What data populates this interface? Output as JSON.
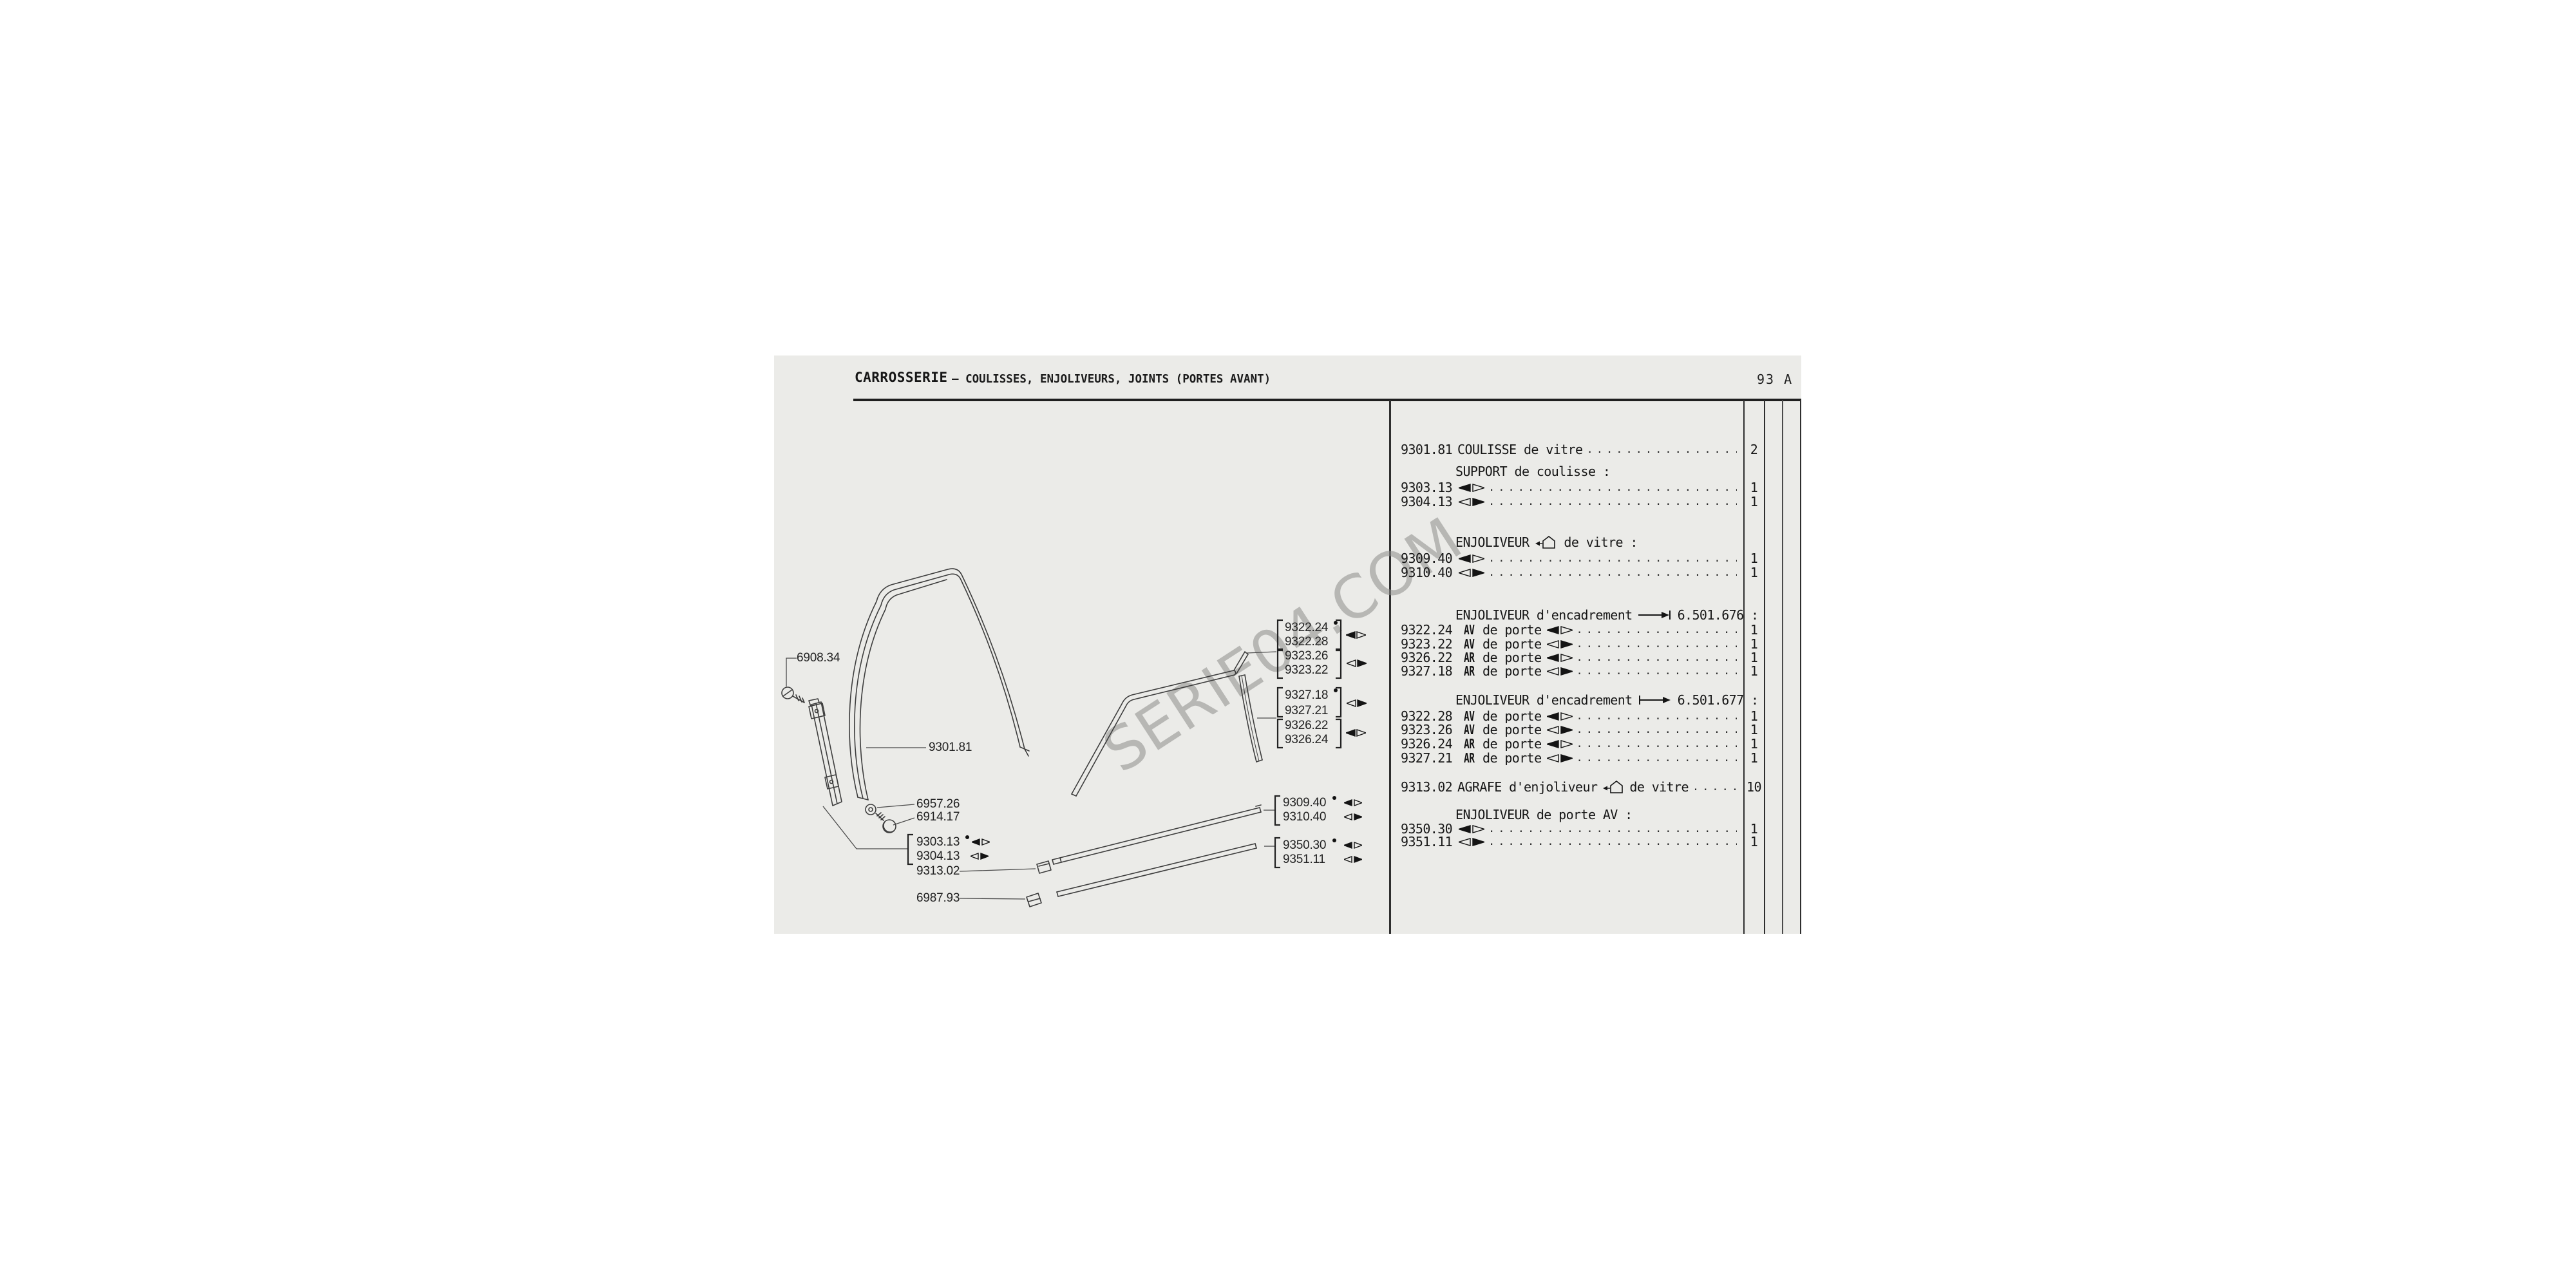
{
  "page": {
    "title": "CARROSSERIE",
    "subtitle": "— COULISSES, ENJOLIVEURS, JOINTS (PORTES AVANT)",
    "page_number": "93 A",
    "watermark": "SERIE04.COM"
  },
  "icons": {
    "side_left": "left-filled-double-arrow-icon",
    "side_right": "right-filled-double-arrow-icon",
    "frame_profile": "window-frame-profile-icon",
    "upto_serial": "arrow-to-bar-icon",
    "from_serial": "arrow-from-bar-icon"
  },
  "parts_list": {
    "sections": [
      {
        "rows": [
          {
            "ref": "9301.81",
            "desc": "COULISSE de vitre",
            "qty": "2"
          }
        ]
      },
      {
        "header": {
          "pre": "SUPPORT de coulisse :"
        },
        "rows": [
          {
            "ref": "9303.13",
            "side": "left",
            "qty": "1"
          },
          {
            "ref": "9304.13",
            "side": "right",
            "qty": "1"
          }
        ]
      },
      {
        "header": {
          "pre": "ENJOLIVEUR",
          "icon": "frame_profile",
          "post": "de vitre :"
        },
        "rows": [
          {
            "ref": "9309.40",
            "side": "left",
            "qty": "1"
          },
          {
            "ref": "9310.40",
            "side": "right",
            "qty": "1"
          }
        ]
      },
      {
        "header": {
          "pre": "ENJOLIVEUR d'encadrement",
          "icon": "upto_serial",
          "post": "6.501.676 :"
        },
        "rows": [
          {
            "ref": "9322.24",
            "prefix": "AV",
            "desc": "de porte",
            "side": "left",
            "qty": "1"
          },
          {
            "ref": "9323.22",
            "prefix": "AV",
            "desc": "de porte",
            "side": "right",
            "qty": "1"
          },
          {
            "ref": "9326.22",
            "prefix": "AR",
            "desc": "de porte",
            "side": "left",
            "qty": "1"
          },
          {
            "ref": "9327.18",
            "prefix": "AR",
            "desc": "de porte",
            "side": "right",
            "qty": "1"
          }
        ]
      },
      {
        "header": {
          "pre": "ENJOLIVEUR d'encadrement",
          "icon": "from_serial",
          "post": "6.501.677 :"
        },
        "rows": [
          {
            "ref": "9322.28",
            "prefix": "AV",
            "desc": "de porte",
            "side": "left",
            "qty": "1"
          },
          {
            "ref": "9323.26",
            "prefix": "AV",
            "desc": "de porte",
            "side": "right",
            "qty": "1"
          },
          {
            "ref": "9326.24",
            "prefix": "AR",
            "desc": "de porte",
            "side": "left",
            "qty": "1"
          },
          {
            "ref": "9327.21",
            "prefix": "AR",
            "desc": "de porte",
            "side": "right",
            "qty": "1"
          }
        ]
      },
      {
        "rows": [
          {
            "ref": "9313.02",
            "desc": "AGRAFE d'enjoliveur",
            "icon": "frame_profile",
            "desc2": "de vitre",
            "qty": "10"
          }
        ]
      },
      {
        "header": {
          "pre": "ENJOLIVEUR de porte AV :"
        },
        "rows": [
          {
            "ref": "9350.30",
            "side": "left",
            "qty": "1"
          },
          {
            "ref": "9351.11",
            "side": "right",
            "qty": "1"
          }
        ]
      }
    ]
  },
  "diagram": {
    "callouts": {
      "c6908": "6908.34",
      "c9301": "9301.81",
      "c6957": "6957.26",
      "c6914": "6914.17",
      "c9303": "9303.13",
      "c9304": "9304.13",
      "c9313": "9313.02",
      "c6987": "6987.93",
      "c9322_24": "9322.24",
      "c9322_28": "9322.28",
      "c9323_26": "9323.26",
      "c9323_22": "9323.22",
      "c9327_18": "9327.18",
      "c9327_21": "9327.21",
      "c9326_22": "9326.22",
      "c9326_24": "9326.24",
      "c9309": "9309.40",
      "c9310": "9310.40",
      "c9350": "9350.30",
      "c9351": "9351.11"
    }
  }
}
